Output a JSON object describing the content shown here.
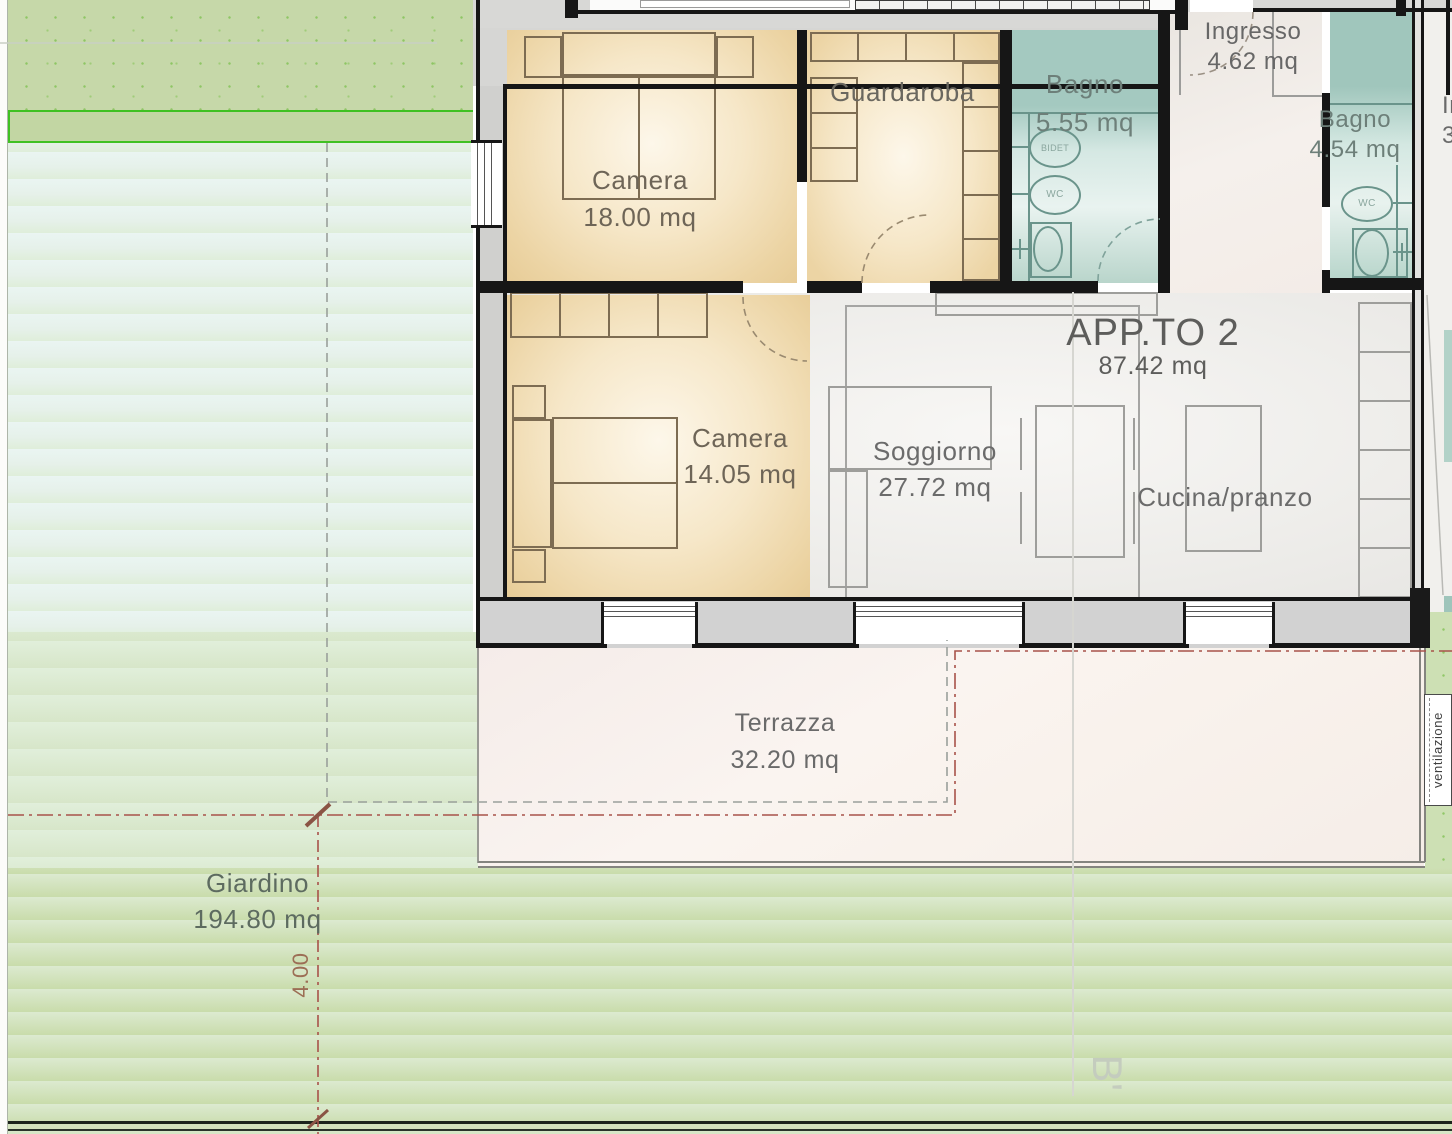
{
  "rooms": {
    "camera1": {
      "label": "Camera",
      "area": "18.00 mq"
    },
    "guardaroba": {
      "label": "Guardaroba"
    },
    "bagno1": {
      "label": "Bagno",
      "area": "5.55 mq"
    },
    "ingresso": {
      "label": "Ingresso",
      "area": "4.62 mq"
    },
    "bagno2": {
      "label": "Bagno",
      "area": "4.54 mq"
    },
    "camera2": {
      "label": "Camera",
      "area": "14.05 mq"
    },
    "soggiorno": {
      "label": "Soggiorno",
      "area": "27.72 mq"
    },
    "cucina": {
      "label": "Cucina/pranzo"
    },
    "terrazza": {
      "label": "Terrazza",
      "area": "32.20 mq"
    },
    "giardino": {
      "label": "Giardino",
      "area": "194.80 mq"
    }
  },
  "apartment": {
    "name": "APP.TO 2",
    "area": "87.42 mq"
  },
  "fixtures": {
    "bidet": "BIDET",
    "wc1": "WC",
    "wc2": "WC"
  },
  "annotations": {
    "dimension": "4.00",
    "ventilation": "ventilazione",
    "section_marker": "B'",
    "adjacent_text_line1": "In",
    "adjacent_text_line2": "3"
  },
  "colors": {
    "wall": "#161616",
    "bedroom_fill": "#ecd4a4",
    "bathroom_fill": "#a4c9c0",
    "living_fill": "#eceae7",
    "terrace_fill": "#f8f1ec",
    "garden_green": "#c6d8a9",
    "lawn_green": "#cfe0b6",
    "boundary_green": "#3fc122",
    "boundary_red": "#a8524a",
    "label_text": "#6b6b6b"
  }
}
